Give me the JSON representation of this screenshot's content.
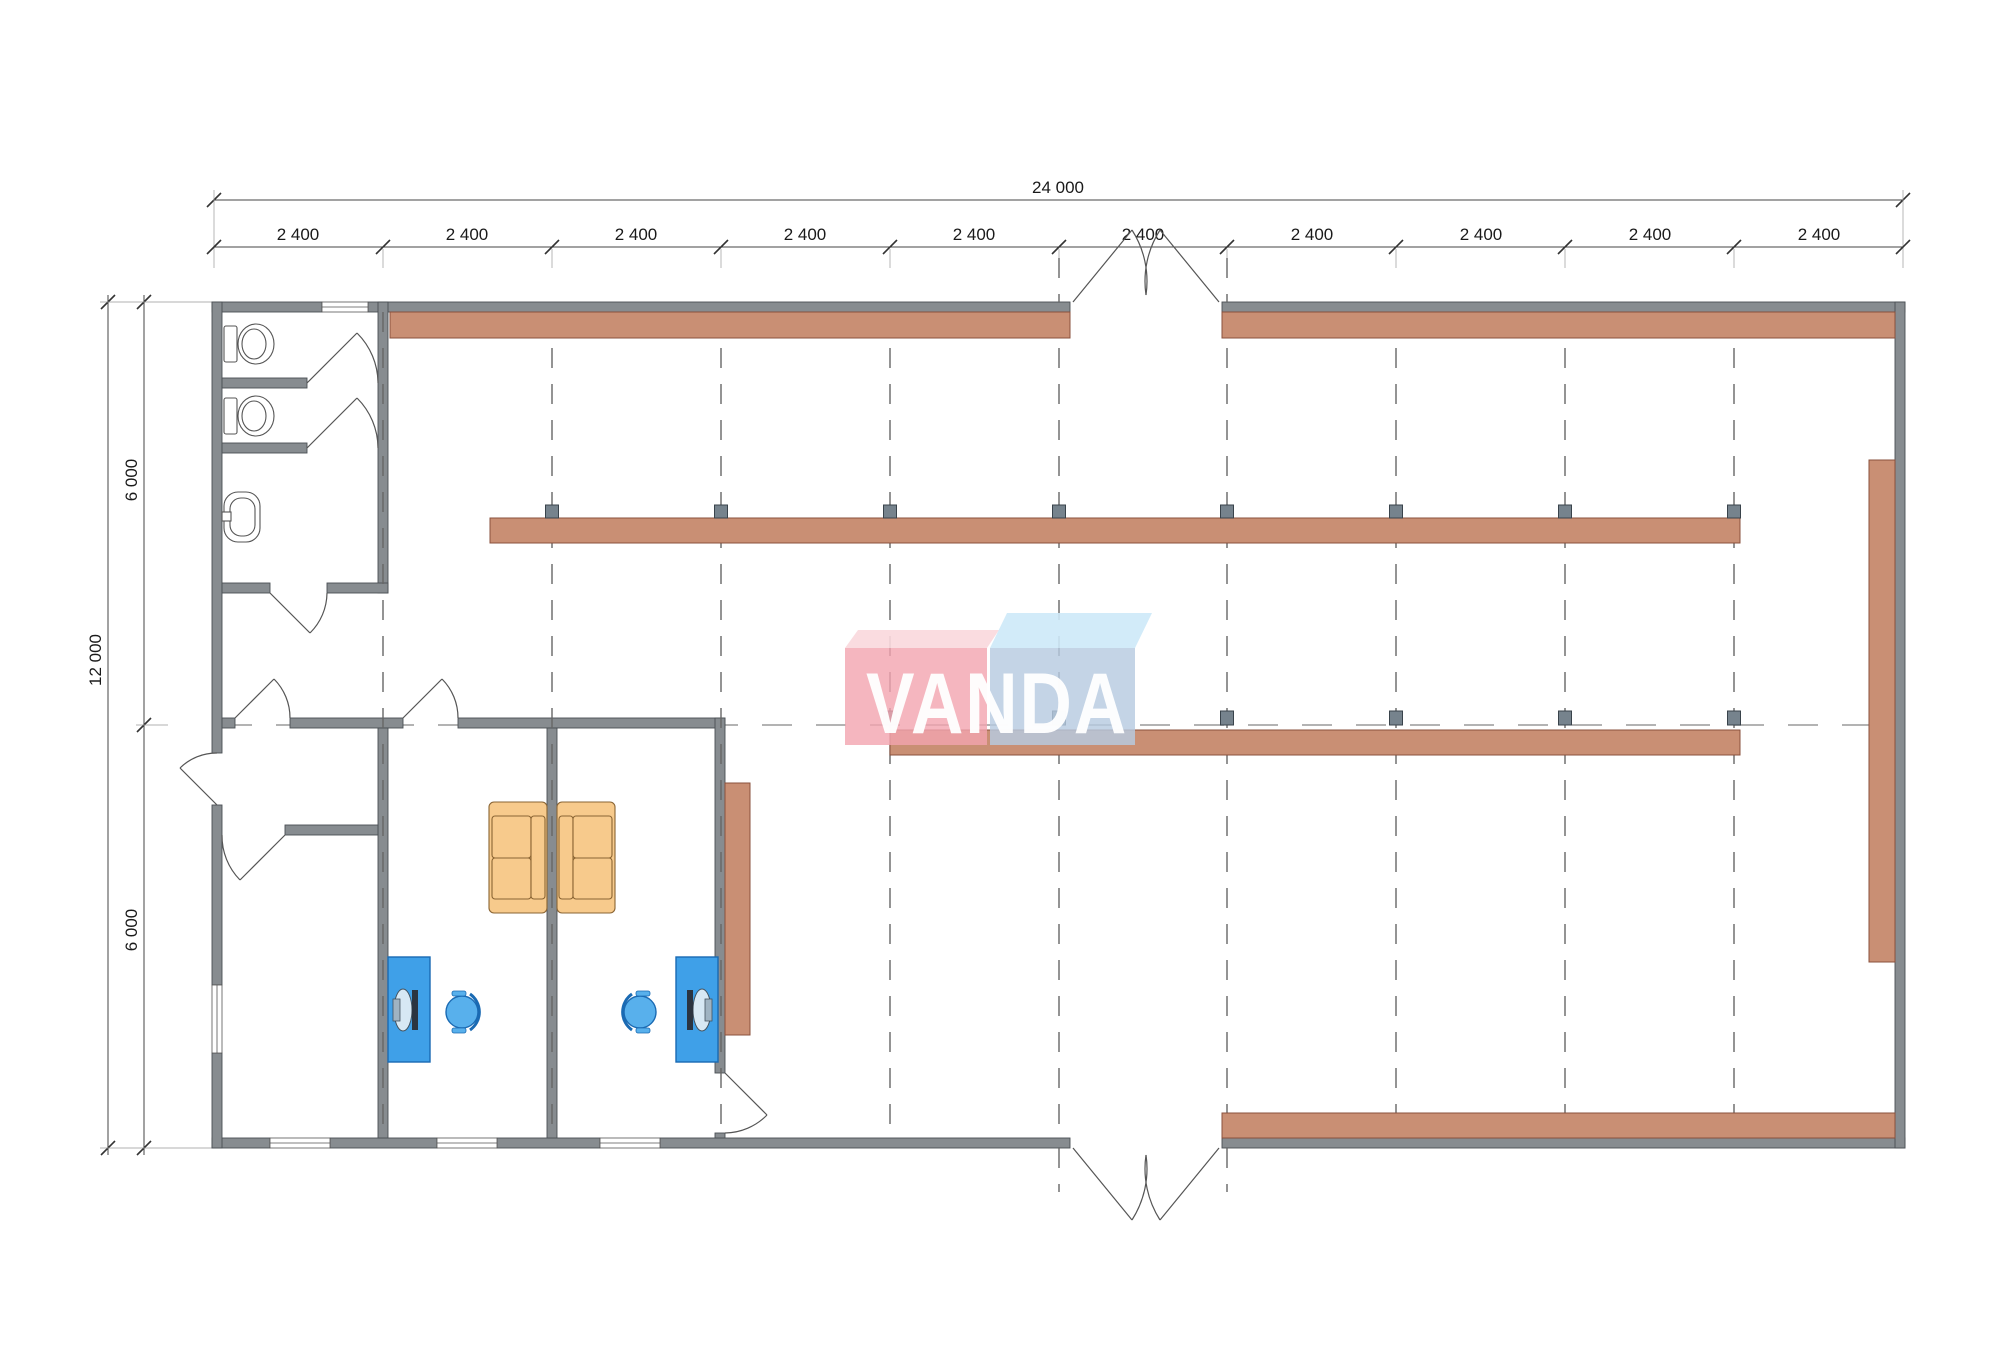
{
  "dims": {
    "total_width": "24 000",
    "top_segments": [
      "2 400",
      "2 400",
      "2 400",
      "2 400",
      "2 400",
      "2 400",
      "2 400",
      "2 400",
      "2 400",
      "2 400"
    ],
    "total_height": "12 000",
    "left_segments": [
      "6 000",
      "6 000"
    ]
  },
  "logo": {
    "text": "VANDA",
    "pink": "#f2a4af",
    "pink_top": "#fad8dd",
    "blue": "#b7cbe0",
    "blue_top": "#cde9f8"
  },
  "colors": {
    "wall": "#878c90",
    "shelf": "#c98f74",
    "shelf_border": "#8a503c",
    "column_marker": "#76838d",
    "desk": "#3fa0e8",
    "chair": "#58b0ec",
    "monitor": "#2b3440",
    "sofa": "#f7ca8c",
    "dimension_text": "#1a1a1a"
  }
}
